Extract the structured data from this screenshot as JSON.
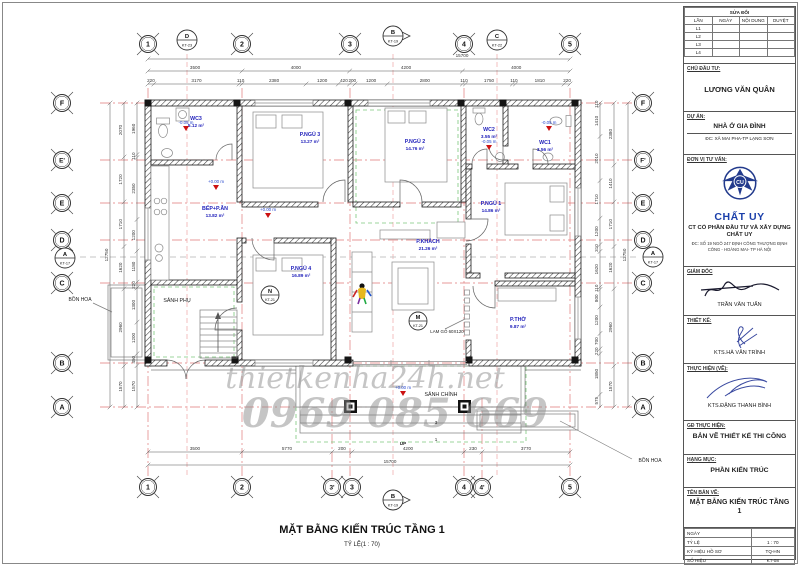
{
  "sheet": {
    "title": "MẶT BẰNG KIẾN TRÚC TẦNG 1",
    "scale_note": "TỶ LỆ(1 : 70)"
  },
  "watermark": {
    "line1": "thietkenha24h.net",
    "line2": "0969 085 669"
  },
  "titleblock": {
    "revisions": {
      "title": "SỬA ĐỔI",
      "columns": [
        "LẦN",
        "NGÀY",
        "NỘI DUNG",
        "DUYỆT"
      ],
      "rows": [
        "L1",
        "L2",
        "L3",
        "L4"
      ]
    },
    "owner": {
      "label": "CHỦ ĐẦU TƯ:",
      "name": "LƯƠNG VĂN QUÂN"
    },
    "project": {
      "label": "DỰ ÁN:",
      "name": "NHÀ Ở GIA ĐÌNH",
      "address": "ĐC: XÃ MAI PHA-TP LẠNG SƠN"
    },
    "consultant": {
      "label": "ĐƠN VỊ TƯ VẤN:",
      "logo_monogram": "CU",
      "brand": "CHẤT UY",
      "company": "CT CỔ PHẦN ĐẦU TƯ VÀ XÂY DỰNG CHẤT UY",
      "address": "ĐC: SỐ 19 NGÕ 247 ĐỊNH CÔNG THƯỢNG ĐỊNH CÔNG - HOÀNG MAI- TP HÀ NỘI"
    },
    "director": {
      "label": "GIÁM ĐỐC",
      "name": "TRẦN VĂN TUẤN"
    },
    "designer": {
      "label": "THIẾT KẾ:",
      "name": "KTS.HÀ VĂN TRÌNH"
    },
    "drafter": {
      "label": "THỰC HIỆN (VẼ):",
      "name": "KTS.ĐẶNG THANH BÌNH"
    },
    "stage": {
      "label": "GĐ THỰC HIỆN:",
      "value": "BẢN VẼ THIẾT KẾ THI CÔNG"
    },
    "category": {
      "label": "HẠNG MỤC:",
      "value": "PHẦN KIẾN TRÚC"
    },
    "drawing_name": {
      "label": "TÊN BẢN VẼ:",
      "value": "MẶT BẰNG KIẾN TRÚC TẦNG 1"
    },
    "info": {
      "rows": [
        {
          "label": "NGÀY",
          "value": ""
        },
        {
          "label": "TỶ LỆ",
          "value": "1 : 70"
        },
        {
          "label": "KÝ HIỆU HỒ SƠ",
          "value": "TQ-HN"
        },
        {
          "label": "SỐ HIỆU",
          "value": "KT-08"
        }
      ]
    }
  },
  "plan": {
    "grid": {
      "top": [
        "1",
        "2",
        "3",
        "4",
        "5"
      ],
      "bottom": [
        "1",
        "2",
        "3'",
        "3",
        "4",
        "4'",
        "5"
      ],
      "left": [
        "F",
        "E'",
        "E",
        "D",
        "C",
        "B",
        "A"
      ],
      "right": [
        "F",
        "F'",
        "E",
        "D",
        "C",
        "B",
        "A"
      ]
    },
    "section_markers": [
      {
        "letter": "D",
        "ref": "KT-23"
      },
      {
        "letter": "B",
        "ref": "KT-19"
      },
      {
        "letter": "C",
        "ref": "KT-22"
      },
      {
        "letter": "A",
        "ref": "KT-17"
      },
      {
        "letter": "A",
        "ref": "KT-17"
      },
      {
        "letter": "B",
        "ref": "KT-19"
      }
    ],
    "detail_markers": [
      {
        "letter": "N",
        "ref": "KT-21"
      },
      {
        "letter": "M",
        "ref": "KT-21"
      }
    ],
    "rooms": [
      {
        "name": "WC3",
        "area": "5.12 m²"
      },
      {
        "name": "P.NGỦ 3",
        "area": "13.27 m²"
      },
      {
        "name": "P.NGỦ 2",
        "area": "14.76 m²"
      },
      {
        "name": "WC2",
        "area": "3.55 m²"
      },
      {
        "name": "WC1",
        "area": "3.56 m²"
      },
      {
        "name": "P.NGỦ 1",
        "area": "14.86 m²"
      },
      {
        "name": "BẾP+P.ĂN",
        "area": "13.82 m²"
      },
      {
        "name": "P.NGỦ 4",
        "area": "16.89 m²"
      },
      {
        "name": "P.KHÁCH",
        "area": "21.26 m²"
      },
      {
        "name": "P.THỜ",
        "area": "9.87 m²"
      },
      {
        "name": "SẢNH PHỤ",
        "area": ""
      },
      {
        "name": "SẢNH CHÍNH",
        "area": ""
      }
    ],
    "elevations": [
      "-0.05 m",
      "+0.00 m",
      "+0.00 m",
      "-0.05 m",
      "-0.05 m",
      "+0.00 m"
    ],
    "annotations": [
      "BỒN HOA",
      "BỒN HOA",
      "LAM GỖ 60X120",
      "UP",
      "3",
      "1"
    ],
    "dimensions": {
      "top_total": "15700",
      "top_spans": [
        "3500",
        "4000",
        "4200",
        "4000"
      ],
      "top_details": [
        "220",
        "3170",
        "110",
        "2380",
        "1200",
        "420",
        "200",
        "1200",
        "2800",
        "110",
        "1750",
        "110",
        "1810",
        "220"
      ],
      "bottom_spans": [
        "3500",
        "5770",
        "200",
        "4200",
        "230",
        "3770"
      ],
      "bottom_total": "15700",
      "left_total": "12750",
      "left_spans": [
        "2070",
        "1720",
        "1710",
        "1620",
        "2960",
        "1570"
      ],
      "left_details": [
        "1960",
        "110",
        "2350",
        "1200",
        "1180",
        "220",
        "1300",
        "1200",
        "450",
        "1570"
      ],
      "right_total": "12750",
      "right_spans": [
        "2380",
        "1410",
        "1710",
        "1620",
        "2960",
        "1570"
      ],
      "right_details": [
        "110",
        "1410",
        "2010",
        "1710",
        "1200",
        "310",
        "1620",
        "110",
        "800",
        "1200",
        "700",
        "220",
        "1850",
        "575"
      ]
    }
  }
}
